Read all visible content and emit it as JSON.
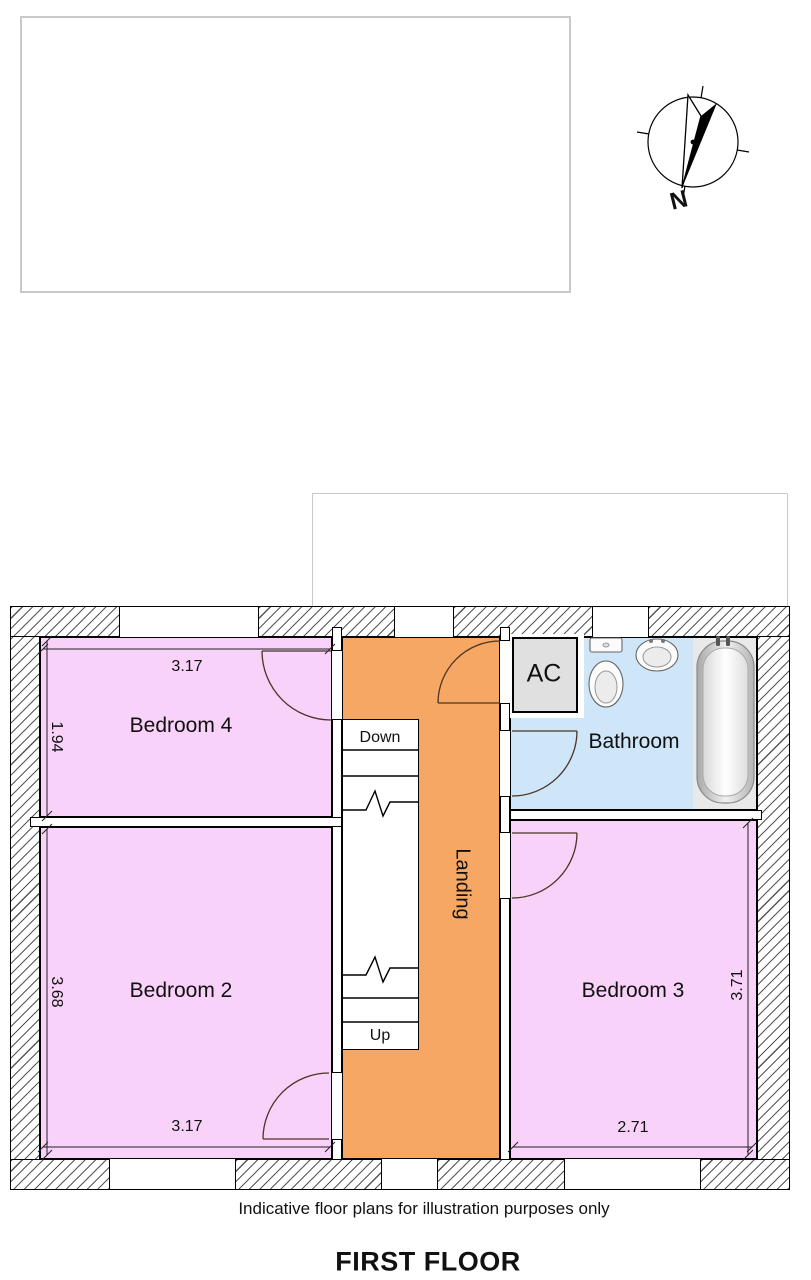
{
  "colors": {
    "bedroom": "#F8D2F8",
    "landing": "#F5A763",
    "bathroom": "#CEE6F8",
    "closet": "#E0E0E0",
    "hatch": "#555555",
    "ph": "#C9C9C9"
  },
  "compass": {
    "north_label": "N"
  },
  "plan": {
    "rooms": {
      "bedroom4": {
        "label": "Bedroom 4",
        "dim_width": "3.17",
        "dim_height": "1.94"
      },
      "bedroom2": {
        "label": "Bedroom 2",
        "dim_width": "3.17",
        "dim_height": "3.68"
      },
      "bedroom3": {
        "label": "Bedroom 3",
        "dim_width": "2.71",
        "dim_height": "3.71"
      },
      "bathroom": {
        "label": "Bathroom"
      },
      "landing": {
        "label": "Landing"
      },
      "airing_cupboard": {
        "label": "AC"
      }
    },
    "stairs": {
      "down_label": "Down",
      "up_label": "Up"
    }
  },
  "footer": {
    "disclaimer": "Indicative floor plans for illustration purposes only",
    "title": "FIRST FLOOR"
  }
}
